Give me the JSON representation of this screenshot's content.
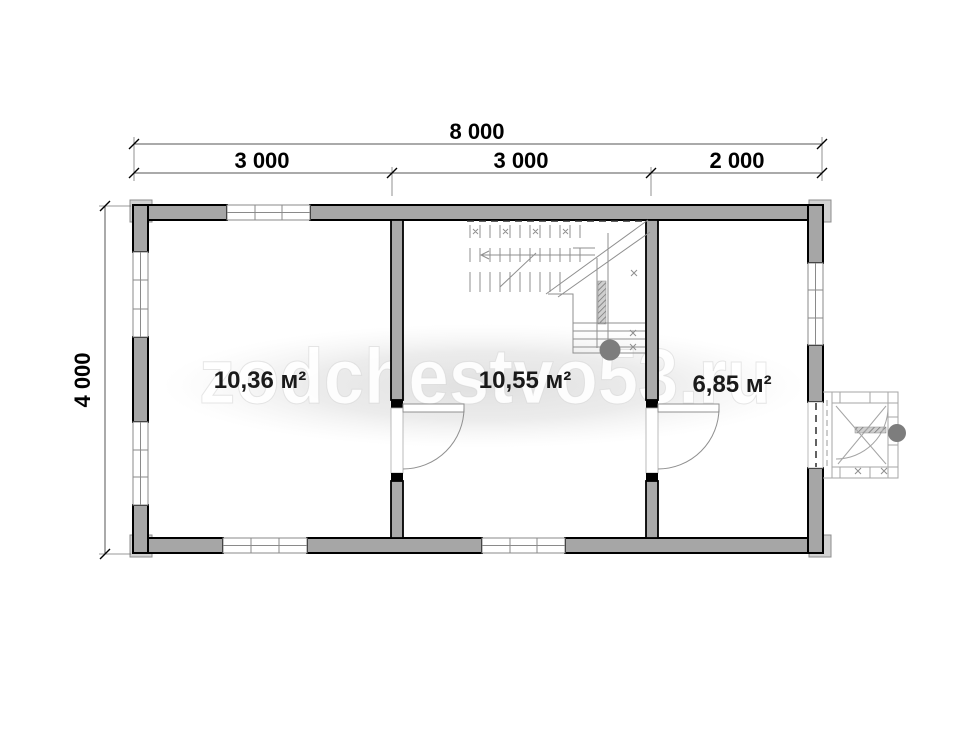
{
  "plan": {
    "dimensions": {
      "overall_width_label": "8 000",
      "width_segment_labels": [
        "3 000",
        "3 000",
        "2 000"
      ],
      "overall_height_label": "4 000"
    },
    "rooms": [
      {
        "name": "room-left",
        "area_label": "10,36 м²"
      },
      {
        "name": "room-middle",
        "area_label": "10,55 м²"
      },
      {
        "name": "room-right",
        "area_label": "6,85 м²"
      }
    ],
    "watermark_text": "zodchestvo53.ru",
    "colors": {
      "wall_fill": "#a6a6a6",
      "wall_outline": "#000000",
      "thin_line": "#8f8f8f",
      "watermark_blob": "#e2e2e2",
      "label_text": "#1a1a1a"
    }
  }
}
